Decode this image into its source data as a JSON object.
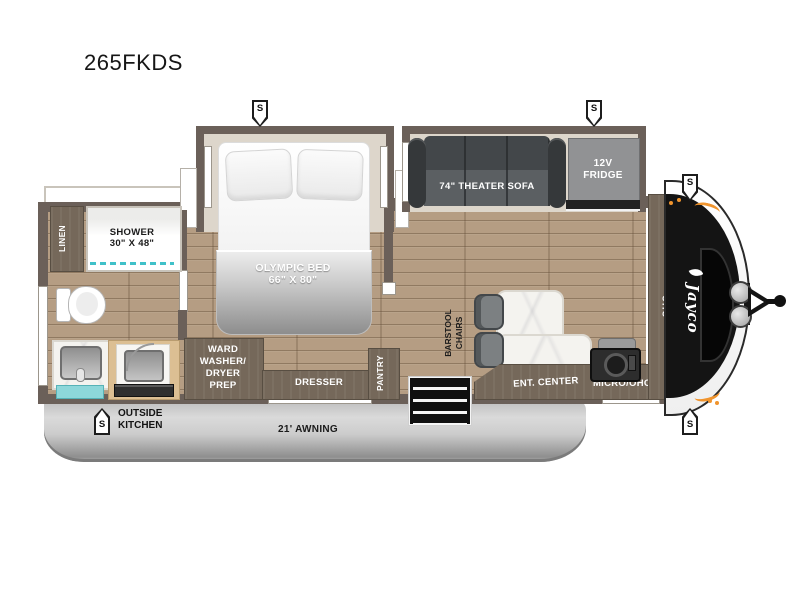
{
  "title": "265FKDS",
  "brand": "Jayco",
  "speaker_label": "S",
  "bedroom": {
    "bed_name": "OLYMPIC BED",
    "bed_size": "66\" X 80\"",
    "dresser": "DRESSER",
    "ward_lines": [
      "WARD",
      "WASHER/",
      "DRYER",
      "PREP"
    ]
  },
  "bathroom": {
    "shower_name": "SHOWER",
    "shower_size": "30\" X 48\"",
    "linen": "LINEN"
  },
  "living": {
    "sofa": "74\" THEATER SOFA",
    "fridge_lines": [
      "12V",
      "FRIDGE"
    ],
    "pantry": "PANTRY",
    "barstool_lines": [
      "BARSTOOL",
      "CHAIRS"
    ],
    "ent_center": "ENT. CENTER",
    "micro": "MICRO/OHC",
    "ohc": "OHC"
  },
  "exterior": {
    "awning": "21' AWNING",
    "outside_kitchen_lines": [
      "OUTSIDE",
      "KITCHEN"
    ]
  },
  "colors": {
    "accent_orange": "#f0942d",
    "teal": "#5fc8cc",
    "wall": "#6b6059",
    "floor_wood": "#b59d83",
    "awning_silver": "#c9c9c9",
    "front_cap": "#141414"
  }
}
